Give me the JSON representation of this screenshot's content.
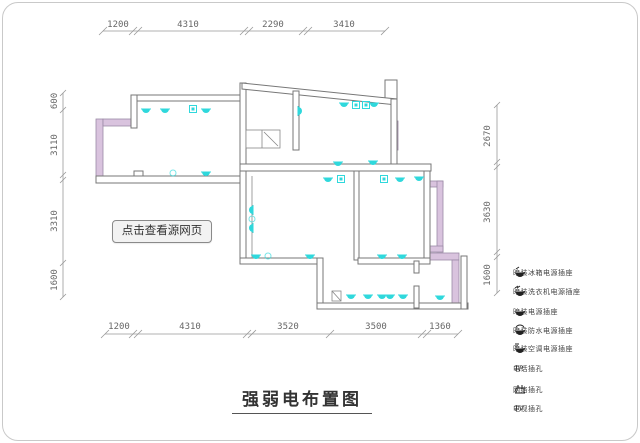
{
  "title": {
    "text": "强弱电布置图"
  },
  "watermark_button": {
    "label": "点击查看源网页"
  },
  "dimensions": {
    "top": [
      "1200",
      "4310",
      "2290",
      "3410"
    ],
    "bottom": [
      "1200",
      "4310",
      "3520",
      "3500",
      "1360"
    ],
    "left": [
      "600",
      "3110",
      "3310",
      "1600"
    ],
    "right": [
      "2670",
      "3630",
      "1600"
    ]
  },
  "legend": {
    "items": [
      {
        "icon": "socket-fridge-icon",
        "label": "暗装冰箱电源插座"
      },
      {
        "icon": "socket-washer-icon",
        "label": "暗装洗衣机电源插座"
      },
      {
        "icon": "socket-icon",
        "label": "暗装电源插座"
      },
      {
        "icon": "socket-waterproof-icon",
        "label": "暗装防水电源插座"
      },
      {
        "icon": "socket-ac-icon",
        "label": "暗装空调电源插座"
      },
      {
        "icon": "phone-jack-icon",
        "label": "电话插孔"
      },
      {
        "icon": "network-jack-icon",
        "label": "网络插孔"
      },
      {
        "icon": "tv-jack-icon",
        "label": "电视插孔"
      }
    ]
  },
  "colors": {
    "wall_line": "#777777",
    "window_fill": "#d9c3de",
    "symbol_cyan": "#2fd8dc",
    "dim_line": "#888888"
  }
}
